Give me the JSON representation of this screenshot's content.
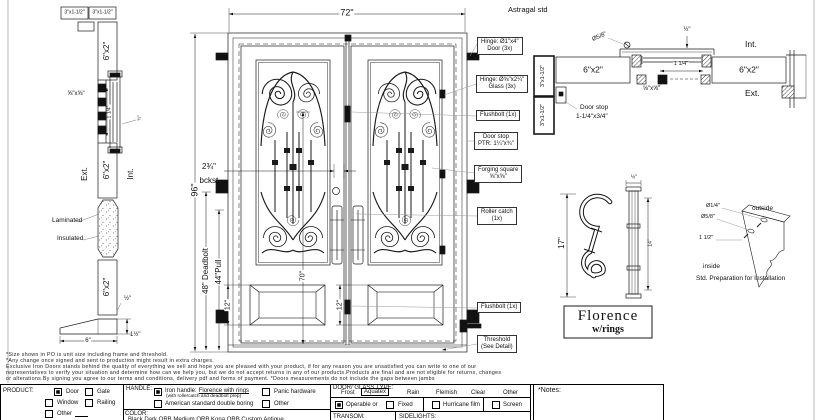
{
  "jamb": {
    "cap1": "3\"x1-1/2\"",
    "cap2": "3\"x1-1/2\"",
    "tube_top": "6\"x2\"",
    "tube_mid": "6\"x2\"",
    "tube_bottom": "6\"x2\"",
    "forging": "⅝\"x⅝\"",
    "glass_gap": "1 1/4\"",
    "stop_half": "½\"",
    "ext": "Ext.",
    "int": "Int.",
    "laminated": "Laminated",
    "insulated": "Insulated",
    "half": "½\"",
    "thr_w": "6\"",
    "thr_h": "1½\""
  },
  "door": {
    "w": "72\"",
    "h": "96\"",
    "backset": "2¾\"",
    "backset_lbl": "bckst.",
    "deadbolt": "48\" Deadbolt",
    "pull": "44\"Pull",
    "glass_h": "70\"",
    "panel_l": "12\"",
    "panel_r": "12\""
  },
  "callouts": [
    {
      "l1": "Hinge: Ø1\"x4\"",
      "l2": "Door (3x)"
    },
    {
      "l1": "Hinge: Ø⅝\"x2¼\"",
      "l2": "Glass (3x)"
    },
    {
      "l1": "Flushbolt (1x)",
      "l2": ""
    },
    {
      "l1": "Door stop",
      "l2": "PTR: 1¼\"x¾\""
    },
    {
      "l1": "Forging square",
      "l2": "⅝\"x⅝\""
    },
    {
      "l1": "Roller catch",
      "l2": "(1x)"
    },
    {
      "l1": "Flushbolt (1x)",
      "l2": ""
    },
    {
      "l1": "Threshold",
      "l2": "(See Detail)"
    }
  ],
  "astragal": {
    "title": "Astragal std",
    "screw": "Ø5/8\"",
    "half": "½\"",
    "int": "Int.",
    "ext": "Ext.",
    "tube_l": "6\"x2\"",
    "tube_r": "6\"x2\"",
    "gap": "1 1/4\"",
    "forging": "⅝\"x⅝\"",
    "jamb1": "3\"x1-1/2\"",
    "jamb2": "3\"x1-1/2\"",
    "stop1": "Door stop",
    "stop2": "1-1/4\"x3/4\""
  },
  "handle": {
    "h": "17\"",
    "side_w": "½\"",
    "side_h": "14\"",
    "name": "Florence",
    "sub": "w/rings"
  },
  "install": {
    "hole1": "Ø1/4\"",
    "hole2": "Ø5/8\"",
    "offset": "1 1/2\"",
    "outside": "outside",
    "inside": "inside",
    "caption": "Std. Preparation for Installation"
  },
  "disclaimer": {
    "line1": "*Size shown in PO is unit size including frame and threshold.",
    "line2": "*Any change once signed and sent to production might result in extra charges.",
    "line3": "Exclusive Iron Doors stands behind the quality of everything we sell and hope you are pleased with your product, if for any reason you are unsatisfied you can write to one of our",
    "line4": "representatives to verify your situation and determine how can we help you, but we do not accept returns in any of our products.Products are final and are not eligible for returns, changes",
    "line5": "or alterations.By signing you agree to our terms and conditions, delivery pdf and forms of payment. *Doors measurements do not include the gaps between jambs"
  },
  "form": {
    "product": {
      "label": "PRODUCT:",
      "door": "Door",
      "gate": "Gate",
      "window": "Window",
      "railing": "Railing",
      "other": "Other"
    },
    "handle": {
      "label": "HANDLE:",
      "iron": "Iron handle:",
      "iron_u": "Florence with rings",
      "iron_sub": "(with rollercatch and deadbolt prep)",
      "panic": "Panic hardware",
      "american": "American standard double boring",
      "other": "Other",
      "color_label": "COLOR:",
      "color_partial": "Black    Dark ORB    Medium ORB    Kona ORB    Custom    Antique"
    },
    "glass": {
      "label": "DOOR/ GLASS TYPE:",
      "frost": "Frost",
      "aquatex": "Aquatex",
      "rain": "Rain",
      "flemish": "Flemish",
      "clear": "Clear",
      "other": "Other",
      "operable": "Operable  or",
      "fixed": "Fixed",
      "hurricane": "Hurricane film",
      "screen": "Screen",
      "transom": "TRANSOM:",
      "sidelights": "SIDELIGHTS:"
    },
    "notes_label": "*Notes:"
  }
}
